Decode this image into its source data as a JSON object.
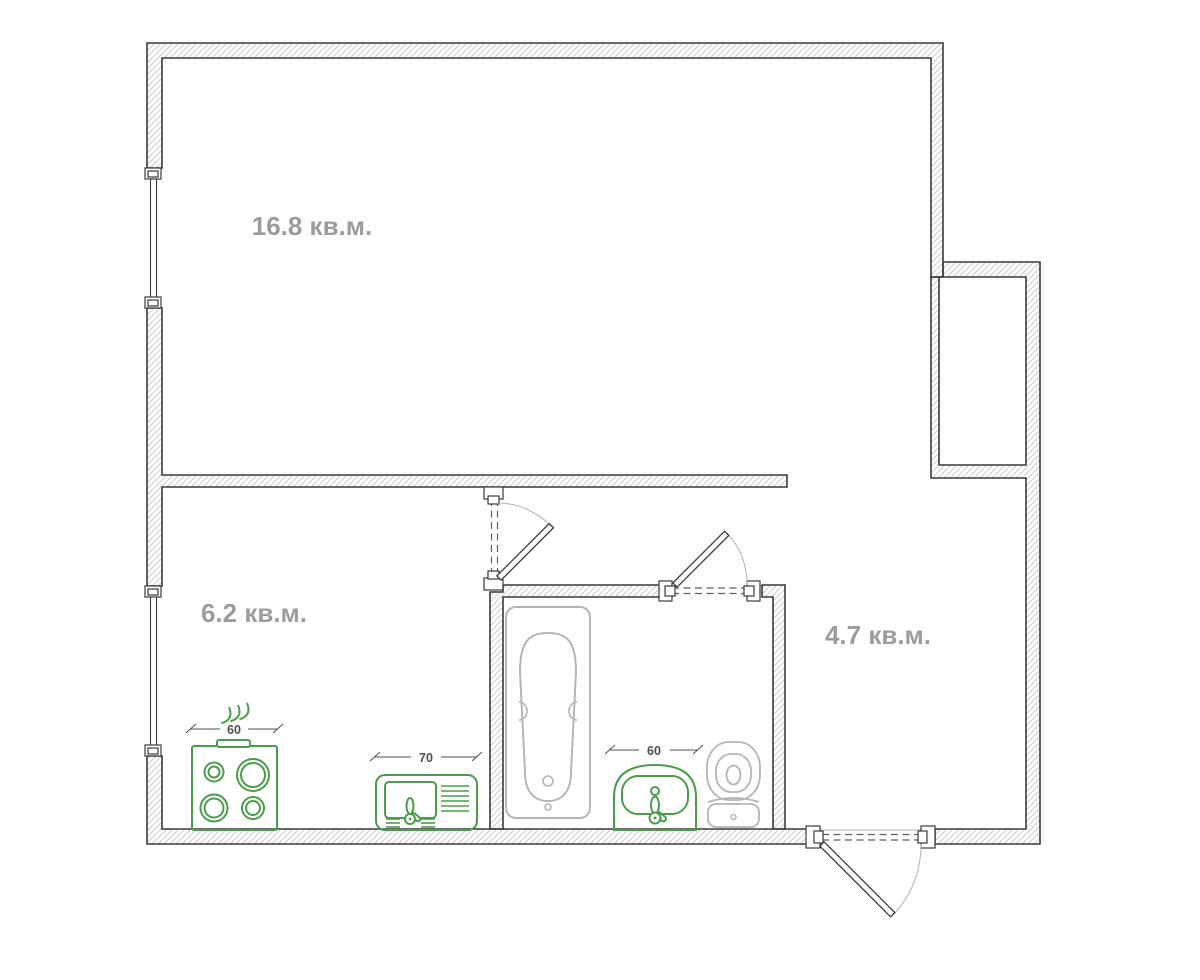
{
  "title": "Однокомнатная квартира — план",
  "rooms": [
    {
      "name": "living-room",
      "area_label": "16.8 кв.м."
    },
    {
      "name": "kitchen",
      "area_label": "6.2 кв.м."
    },
    {
      "name": "hallway",
      "area_label": "4.7 кв.м."
    }
  ],
  "fixtures": {
    "stove": {
      "name": "stove",
      "width_label": "60"
    },
    "kitchen_sink": {
      "name": "kitchen-sink",
      "width_label": "70"
    },
    "washbasin": {
      "name": "washbasin",
      "width_label": "60"
    },
    "bathtub": {
      "name": "bathtub"
    },
    "toilet": {
      "name": "toilet"
    }
  },
  "colors": {
    "background": "#ffffff",
    "wall_line": "#3a3a3a",
    "hatch": "#c6c6c6",
    "room_label": "#9c9c9c",
    "dimension": "#4f4f4f",
    "fixture_green": "#4a9d4a",
    "fixture_gray": "#b5b5b5",
    "door_arc": "#b4b4b4"
  }
}
